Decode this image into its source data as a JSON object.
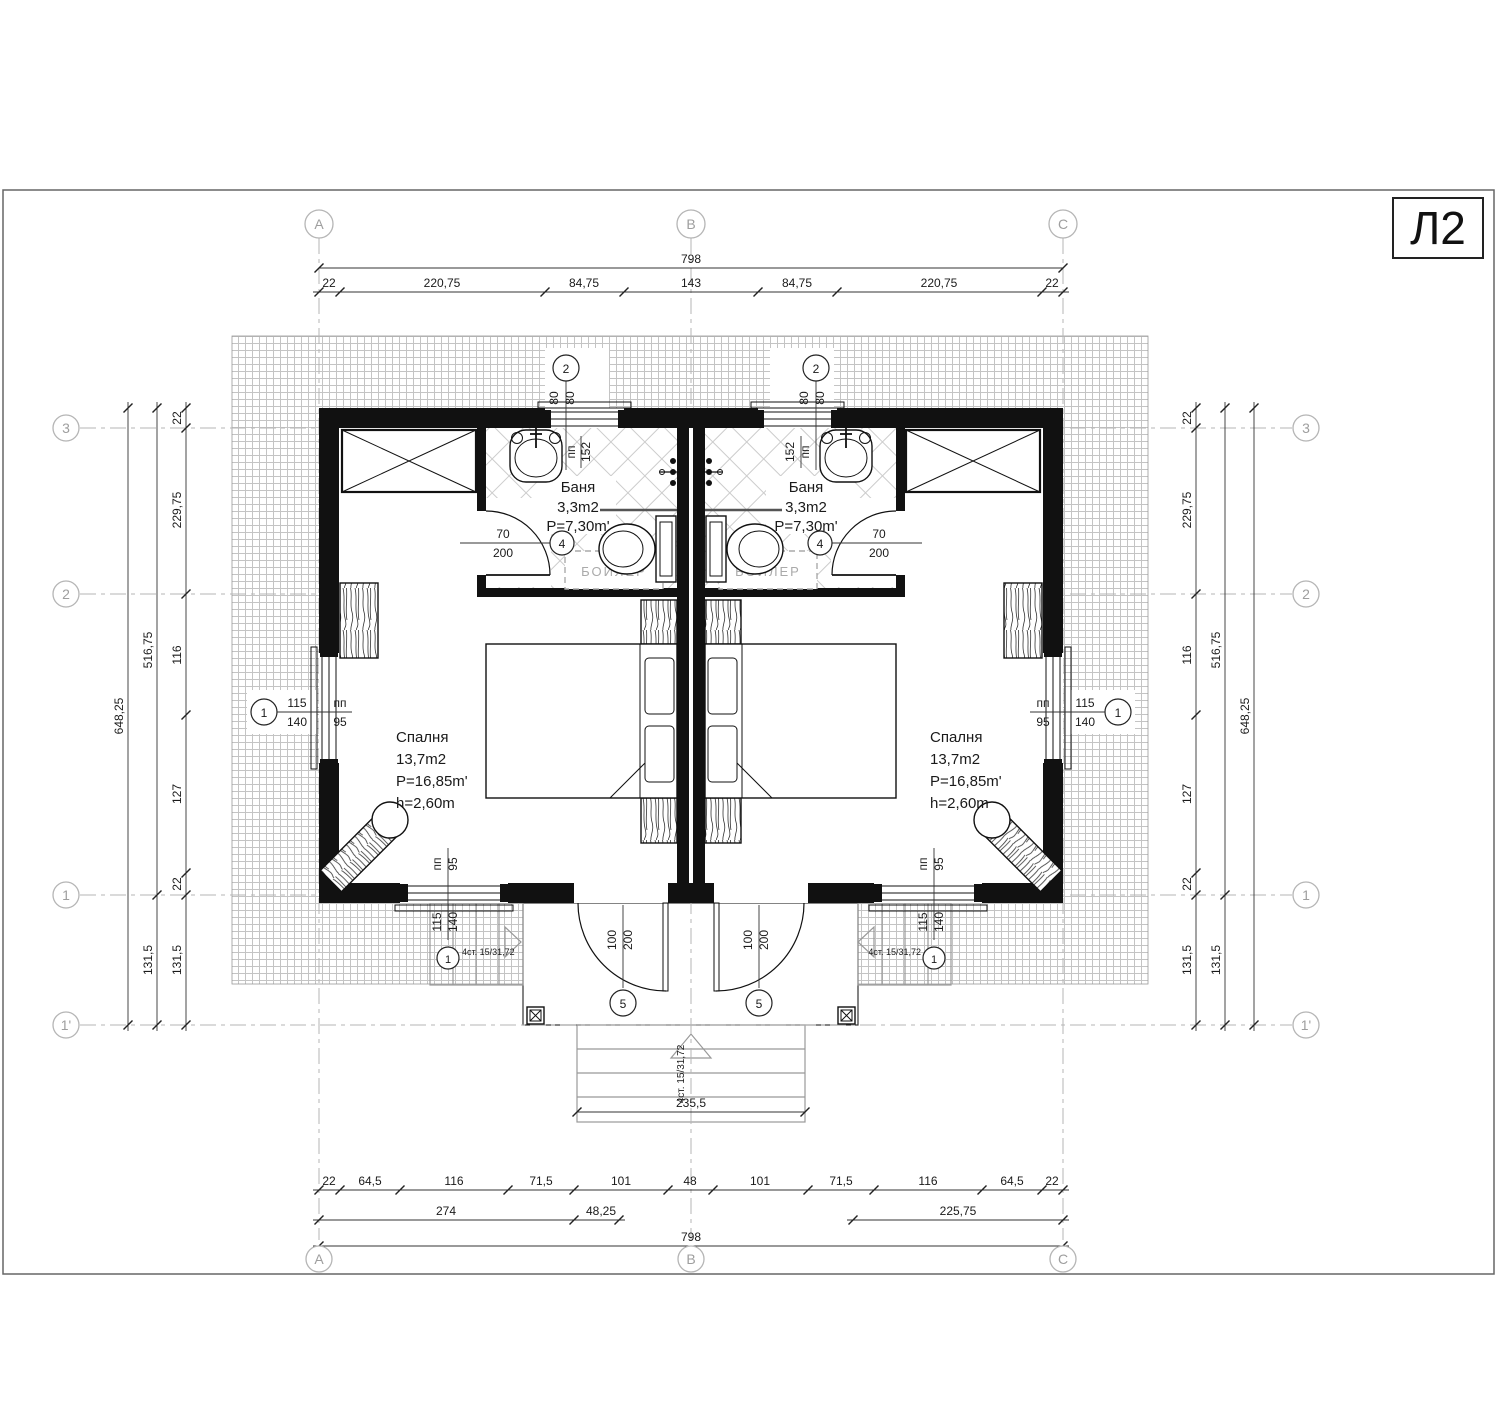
{
  "sheet": {
    "code": "Л2"
  },
  "grid_axes": {
    "col_a": "A",
    "col_b": "B",
    "col_c": "C",
    "row_3": "3",
    "row_2": "2",
    "row_1": "1",
    "row_1p": "1'"
  },
  "dims": {
    "total_width": "798",
    "top_chain": [
      "22",
      "220,75",
      "84,75",
      "143",
      "84,75",
      "220,75",
      "22"
    ],
    "bottom_chain": [
      "22",
      "64,5",
      "116",
      "71,5",
      "101",
      "48",
      "101",
      "71,5",
      "116",
      "64,5",
      "22"
    ],
    "bottom_sub": [
      "274",
      "48,25",
      "225,75"
    ],
    "total_width_bottom": "798",
    "side_total": "648,25",
    "side_mid_upper": "516,75",
    "side_mid_lower": "131,5",
    "side_chain": [
      "22",
      "229,75",
      "116",
      "127",
      "22",
      "131,5"
    ],
    "porch_width": "235,5"
  },
  "rooms": {
    "bedroom": {
      "name": "Спалня",
      "area": "13,7m2",
      "perimeter": "P=16,85m'",
      "height": "h=2,60m"
    },
    "bathroom": {
      "name": "Баня",
      "area": "3,3m2",
      "perimeter": "P=7,30m'"
    },
    "boiler_label": "БОЙЛЕР"
  },
  "tags": {
    "window_side": {
      "no": "1",
      "size_top": "115",
      "size_bot": "140",
      "lintel": "пп",
      "lintel_val": "95"
    },
    "window_bath": {
      "no": "2",
      "size_top": "80",
      "size_bot": "80",
      "lintel": "пп",
      "lintel_val": "152"
    },
    "door_bath": {
      "no": "4",
      "size_top": "70",
      "size_bot": "200"
    },
    "door_entry": {
      "no": "5",
      "size_top": "100",
      "size_bot": "200"
    }
  },
  "stairs": {
    "note": "4ст. 15/31,72"
  }
}
